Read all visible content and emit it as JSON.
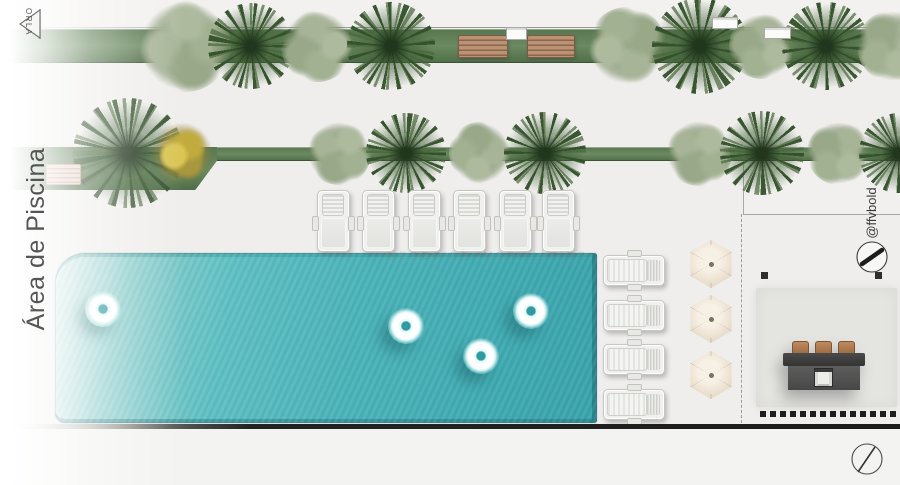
{
  "labels": {
    "orla": "ORLA",
    "area": "Área de Piscina",
    "watermark": "NEGÓCIOS IMOBILIÁRIOS",
    "credit": "@ffvbold"
  },
  "colors": {
    "pool_water": "#49b2b8",
    "pool_edge": "#1f7a80",
    "grass_strip": "#6b8a61",
    "bush": "#95a586",
    "palm": "#32502a",
    "flower_tree": "#c2ab3e",
    "bench_wood": "#bb9273",
    "bench_pink": "#e9d3cb",
    "lounger": "#f0f0ee",
    "umbrella": "#eadfce",
    "grill_body": "#4a4a4a",
    "grill_stool": "#c08a5e",
    "deck": "#e4e4e1",
    "wall": "#1f1f1f"
  },
  "scene": {
    "strips": {
      "top": {
        "cy": 46,
        "trees": [
          {
            "t": "bush",
            "x": 185,
            "s": 92
          },
          {
            "t": "palm",
            "x": 251,
            "s": 86
          },
          {
            "t": "bush",
            "x": 317,
            "s": 72
          },
          {
            "t": "palm",
            "x": 391,
            "s": 88
          },
          {
            "t": "bush",
            "x": 627,
            "s": 78
          },
          {
            "t": "palm",
            "x": 700,
            "s": 96
          },
          {
            "t": "bush",
            "x": 762,
            "s": 66
          },
          {
            "t": "palm",
            "x": 826,
            "s": 88
          },
          {
            "t": "bush",
            "x": 893,
            "s": 72
          }
        ]
      },
      "mid": {
        "cy": 153,
        "trees": [
          {
            "t": "palm",
            "x": 128,
            "s": 110
          },
          {
            "t": "ytree",
            "x": 182,
            "s": 62
          },
          {
            "t": "bush",
            "x": 339,
            "s": 64
          },
          {
            "t": "palm",
            "x": 406,
            "s": 80
          },
          {
            "t": "bush",
            "x": 480,
            "s": 62
          },
          {
            "t": "palm",
            "x": 545,
            "s": 82
          },
          {
            "t": "bush",
            "x": 699,
            "s": 66
          },
          {
            "t": "palm",
            "x": 762,
            "s": 84
          },
          {
            "t": "bush",
            "x": 839,
            "s": 64
          },
          {
            "t": "palm",
            "x": 899,
            "s": 80
          }
        ]
      }
    },
    "benches_top": [
      {
        "x": 458,
        "y": 35,
        "w": 48,
        "h": 21
      },
      {
        "x": 527,
        "y": 35,
        "w": 46,
        "h": 21
      }
    ],
    "bench_left": {
      "x": 46,
      "y": 164,
      "w": 33,
      "h": 19
    },
    "structure_boxes": [
      {
        "x": 506,
        "y": 27,
        "w": 19,
        "h": 11
      },
      {
        "x": 712,
        "y": 17,
        "w": 24,
        "h": 10
      },
      {
        "x": 764,
        "y": 27,
        "w": 25,
        "h": 10
      }
    ],
    "floats": [
      {
        "x": 103,
        "y": 309
      },
      {
        "x": 406,
        "y": 326
      },
      {
        "x": 481,
        "y": 356
      },
      {
        "x": 531,
        "y": 311
      }
    ],
    "loungers_top": {
      "w": 33,
      "h": 62,
      "y": 190,
      "xs": [
        333,
        378,
        424,
        469,
        515,
        558
      ]
    },
    "loungers_side": {
      "x": 603,
      "w": 62,
      "h": 31,
      "ys": [
        255,
        300,
        344,
        389
      ]
    },
    "umbrellas": {
      "s": 48,
      "pts": [
        {
          "x": 711,
          "y": 264
        },
        {
          "x": 711,
          "y": 319
        },
        {
          "x": 711,
          "y": 375
        }
      ]
    },
    "posts": [
      {
        "x": 761,
        "y": 272
      },
      {
        "x": 875,
        "y": 272
      }
    ],
    "dots_row": {
      "x": 760,
      "y": 411,
      "n": 14,
      "step": 10,
      "s": 6
    },
    "stool_offsets": [
      9,
      32,
      55
    ]
  }
}
